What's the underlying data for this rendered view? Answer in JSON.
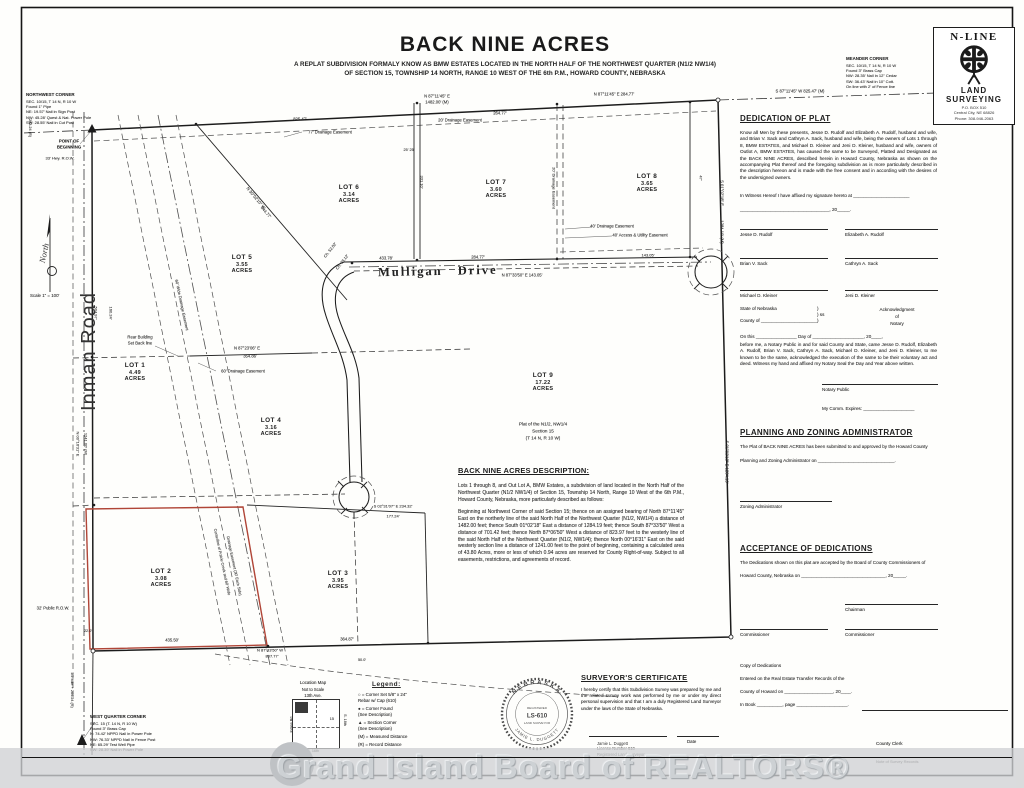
{
  "title": {
    "main": "BACK NINE ACRES",
    "sub1": "A REPLAT SUBDIVISION FORMALY KNOW AS BMW ESTATES LOCATED IN THE NORTH HALF OF THE NORTHWEST QUARTER (N1/2 NW1/4)",
    "sub2": "OF SECTION 15, TOWNSHIP 14 NORTH, RANGE 10 WEST OF THE 6th P.M., HOWARD COUNTY, NEBRASKA"
  },
  "logo": {
    "name": "N-LINE",
    "land": "LAND",
    "surveying": "SURVEYING",
    "addr1": "P.O. BOX 510",
    "addr2": "Central City, NE 68826",
    "addr3": "Phone: 308-946-2063"
  },
  "corner_notes": {
    "northwest": {
      "title": "NORTHWEST CORNER",
      "lines": [
        "SEC. 10/15, T 14 N, R 10 W",
        "Found 1\" Pipe",
        "NE: 19.57' Nail in Sign Post",
        "NW: 45.28' Quest & Nat. Power Pole",
        "SW: 28.55' Nail in Cut Post"
      ]
    },
    "meander": {
      "title": "MEANDER CORNER",
      "lines": [
        "SEC. 10/15, T 14 N, R 10 W",
        "Found 3\" Brass Cap",
        "NW: 28.35' Nail in 12\" Cedar",
        "SW: 36.43' Nail in 10\" Cott.",
        "On line with 2' of Fence line"
      ]
    },
    "west_quarter": {
      "title": "WEST QUARTER CORNER",
      "lines": [
        "SEC. 15 (T. 14 N, R 10 W)",
        "Found 3\" Brass Cap",
        "N: 74.42' NPPD Nail in Power Pole",
        "NW: 76.33' NPPD Nail in Fence Post",
        "NE: 65.29' Test Well Pipe",
        "SW: 28.39' Nail in Power Pole"
      ]
    }
  },
  "map": {
    "north": "North",
    "scale": "Scale 1\" = 100'",
    "inman": "Inman Road",
    "mulligan": "Mulligan Drive",
    "lots": [
      {
        "name": "LOT 1",
        "acres": "4.49 ACRES",
        "x": 135,
        "y": 372
      },
      {
        "name": "LOT 2",
        "acres": "3.08 ACRES",
        "x": 161,
        "y": 578
      },
      {
        "name": "LOT 3",
        "acres": "3.95 ACRES",
        "x": 338,
        "y": 580
      },
      {
        "name": "LOT 4",
        "acres": "3.16 ACRES",
        "x": 271,
        "y": 427
      },
      {
        "name": "LOT 5",
        "acres": "3.55 ACRES",
        "x": 242,
        "y": 264
      },
      {
        "name": "LOT 6",
        "acres": "3.14 ACRES",
        "x": 349,
        "y": 194
      },
      {
        "name": "LOT 7",
        "acres": "3.60 ACRES",
        "x": 496,
        "y": 189
      },
      {
        "name": "LOT 8",
        "acres": "3.65 ACRES",
        "x": 647,
        "y": 183
      },
      {
        "name": "LOT 9",
        "acres": "17.22 ACRES",
        "x": 543,
        "y": 382
      }
    ],
    "labels": [
      {
        "t": "825.47'",
        "x": 300,
        "y": 119,
        "s": 4.2
      },
      {
        "t": "77' Drainage Easement",
        "x": 330,
        "y": 132,
        "s": 4.2
      },
      {
        "t": "264.77'",
        "x": 500,
        "y": 113,
        "s": 4.2
      },
      {
        "t": "20' Drainage Easement",
        "x": 460,
        "y": 120,
        "s": 4.2
      },
      {
        "t": "N 87°11'45\" E",
        "x": 437,
        "y": 96,
        "s": 4.2
      },
      {
        "t": "1482.00' (M)",
        "x": 437,
        "y": 102,
        "s": 4.2
      },
      {
        "t": "N 87°11'45\" E  284.77'",
        "x": 614,
        "y": 94,
        "s": 4.2
      },
      {
        "t": "S 87°11'45\" W  825.47' (M)",
        "x": 800,
        "y": 91,
        "s": 4.2
      },
      {
        "t": "S 01°02'18\" E",
        "x": 722,
        "y": 193,
        "r": 90,
        "s": 4.2
      },
      {
        "t": "1284.19' (M)",
        "x": 722,
        "y": 232,
        "r": 90,
        "s": 4.2
      },
      {
        "t": "47'",
        "x": 701,
        "y": 178,
        "r": 90,
        "s": 4
      },
      {
        "t": "S 01°02'18\" E  1284.19'",
        "x": 727,
        "y": 462,
        "r": 90,
        "s": 4.2
      },
      {
        "t": "433.78'",
        "x": 386,
        "y": 258,
        "s": 4.2
      },
      {
        "t": "284.77'",
        "x": 478,
        "y": 257,
        "s": 4.2
      },
      {
        "t": "N 87°33'50\" E  143.05'",
        "x": 522,
        "y": 275,
        "s": 4.2
      },
      {
        "t": "143.05'",
        "x": 648,
        "y": 255,
        "s": 4
      },
      {
        "t": "Ch. 52.02'",
        "x": 330,
        "y": 250,
        "r": -52,
        "s": 4
      },
      {
        "t": "Ch. 78.12'",
        "x": 342,
        "y": 262,
        "r": -52,
        "s": 4
      },
      {
        "t": "N 30°02'10\" W",
        "x": 256,
        "y": 198,
        "r": 50,
        "s": 4.2
      },
      {
        "t": "844.77'",
        "x": 266,
        "y": 212,
        "r": 50,
        "s": 4.2
      },
      {
        "t": "60' Wide Drainage Easement",
        "x": 182,
        "y": 305,
        "r": 78,
        "s": 4
      },
      {
        "t": "Centerline of Prairie Creek and 60' Wide",
        "x": 222,
        "y": 562,
        "r": 78,
        "s": 3.8
      },
      {
        "t": "Drainage Easement (30' Each Side)",
        "x": 234,
        "y": 566,
        "r": 78,
        "s": 3.8
      },
      {
        "t": "N 87°23'06\" E",
        "x": 247,
        "y": 348,
        "s": 4.2
      },
      {
        "t": "354.86'",
        "x": 250,
        "y": 356,
        "s": 4.2
      },
      {
        "t": "60' Drainage Easement",
        "x": 243,
        "y": 371,
        "s": 4.2
      },
      {
        "t": "Rear Building",
        "x": 140,
        "y": 337,
        "s": 4.2
      },
      {
        "t": "Set Back line",
        "x": 140,
        "y": 343,
        "s": 4.2
      },
      {
        "t": "40' Drainage Easement",
        "x": 612,
        "y": 226,
        "s": 4.2
      },
      {
        "t": "40' Access & Utility Easement",
        "x": 640,
        "y": 235,
        "s": 4.2
      },
      {
        "t": "331.10'",
        "x": 422,
        "y": 182,
        "r": 90,
        "s": 4
      },
      {
        "t": "25' 25'",
        "x": 409,
        "y": 150,
        "s": 3.8
      },
      {
        "t": "20' Drainage Easement",
        "x": 554,
        "y": 188,
        "r": 90,
        "s": 4
      },
      {
        "t": "435.50'",
        "x": 172,
        "y": 640,
        "s": 4.2
      },
      {
        "t": "364.87'",
        "x": 347,
        "y": 639,
        "s": 4.2
      },
      {
        "t": "N 87°33'50\" W",
        "x": 270,
        "y": 650,
        "s": 4
      },
      {
        "t": "807.77'",
        "x": 272,
        "y": 656,
        "s": 4
      },
      {
        "t": "S 02°31'07\" E  234.32'",
        "x": 393,
        "y": 506,
        "s": 4
      },
      {
        "t": "177.24'",
        "x": 393,
        "y": 516,
        "s": 4
      },
      {
        "t": "504.97'",
        "x": 96,
        "y": 313,
        "r": 90,
        "s": 4
      },
      {
        "t": "160.24'",
        "x": 111,
        "y": 313,
        "r": 90,
        "s": 4
      },
      {
        "t": "N 00°16'31\" E",
        "x": 78,
        "y": 444,
        "r": 90,
        "s": 4
      },
      {
        "t": "1241.00' (M)",
        "x": 86,
        "y": 444,
        "r": 90,
        "s": 4
      },
      {
        "t": "32' Public R.O.W.",
        "x": 53,
        "y": 608,
        "s": 4.2
      },
      {
        "t": "22.0'",
        "x": 88,
        "y": 631,
        "s": 3.8
      },
      {
        "t": "1/2 Mile + 264.24 (R)",
        "x": 72,
        "y": 690,
        "r": 90,
        "s": 3.8
      },
      {
        "t": "283.24 (R)",
        "x": 30,
        "y": 128,
        "r": 90,
        "s": 3.8
      },
      {
        "t": "33' Hwy. R.O.W.",
        "x": 60,
        "y": 158,
        "s": 4
      },
      {
        "t": "POINT OF",
        "x": 69,
        "y": 141,
        "s": 4.3,
        "b": 1
      },
      {
        "t": "BEGINNING",
        "x": 69,
        "y": 147,
        "s": 4.3,
        "b": 1
      },
      {
        "t": "Plat of the N1/2, NW1/4",
        "x": 543,
        "y": 424,
        "s": 4.6
      },
      {
        "t": "Section 15",
        "x": 543,
        "y": 431,
        "s": 4.6
      },
      {
        "t": "(T 14 N, R 10 W)",
        "x": 543,
        "y": 438,
        "s": 4.6
      },
      {
        "t": "50.0'",
        "x": 362,
        "y": 660,
        "s": 3.8
      }
    ]
  },
  "description": {
    "heading": "BACK NINE ACRES DESCRIPTION:",
    "para1": "Lots 1 through 8, and Out Lot A, BMW Estates, a subdivision of land located in the North Half of the Northwest Quarter (N1/2 NW1/4) of Section 15, Township 14 North, Range 10 West of the 6th P.M., Howard County, Nebraska, more particularly described as follows:",
    "para2": "Beginning at Northwest Corner of said Section 15; thence on an assigned bearing of North 87°11'45\" East on the northerly line of the said North Half of the Northwest Quarter (N1/2, NW1/4) a distance of 1482.00 feet; thence South 01°02'18\" East a distance of 1284.19 feet; thence South 87°33'50\" West a distance of 701.42 feet; thence North 87°06'50\" West a distance of 823.97 feet to the westerly line of the said North Half of the Northwest Quarter (N1/2, NW1/4); thence North 00°16'31\" East on the said westerly section line a distance of 1241.00 feet to the point of beginning, containing a calculated area of 43.80 Acres, more or less of which 0.94 acres are reserved for County Right-of-way.  Subject to all easements, restrictions, and agreements of record."
  },
  "dedication": {
    "heading": "DEDICATION OF PLAT",
    "body": "Know all Men by these presents, Jesse D. Rudolf and Elizabeth A. Rudolf, husband and wife, and Brian V. Sack and Cathryn A. Sack, husband and wife, being the owners of Lots 1 through 8, BMW ESTATES, and Michael D. Kleiner and Jeni D. Kleiner, husband and wife, owners of Outlot A, BMW ESTATES, has caused the same to be Surveyed, Platted and Designated as the BACK NINE ACRES, described herein in Howard County, Nebraska as shown on the accompanying Plat thereof and the foregoing subdivision as is more particularly described in the description hereon and is made with the free consent and in according with the desires of the undersigned owners.",
    "witness1": "In Witness Hereof I have affixed my signature hereto at ______________________",
    "witness2": "___________________________________, 20_____.",
    "signers": [
      "Jesse D. Rudolf",
      "Elizabeth A. Rudolf",
      "Brian V. Sack",
      "Cathryn A. Sack",
      "Michael D. Kleiner",
      "Jeni D. Kleiner"
    ]
  },
  "notary": {
    "state": "State of Nebraska",
    "paren": ")",
    "ss": ") ss",
    "county": "County of ______________________",
    "ack1": "Acknowledgment",
    "ack2": "of",
    "ack3": "Notary",
    "line1": "On this ________________ Day of ____________________, 20____,",
    "body": "before me, a Notary Public in and for said County and State, came Jesse D. Rudolf, Elizabeth A. Rudolf, Brian V. Sack, Cathryn A. Sack, Michael D. Kleiner, and Jeni D. Kleiner, to me known to be the same, acknowledged the execution of the same to be their voluntary act and deed.  Witness my hand and affixed my Notary Seal the Day and Year above written.",
    "public_label": "Notary Public",
    "comm": "My Comm. Expires: ____________________"
  },
  "planning": {
    "heading": "PLANNING AND ZONING ADMINISTRATOR",
    "line1": "The Plat of  BACK NINE ACRES  has been submitted to and approved by the Howard County",
    "line2": "Planning and Zoning Administrator on ______________________________.",
    "sig": "Zoning Administrator"
  },
  "acceptance": {
    "heading": "ACCEPTANCE OF DEDICATIONS",
    "line1": "The Dedications shown on this plat are accepted by the Board of County Commissioners of",
    "line2": "Howard County, Nebraska on _________________________________, 20_____.",
    "chairman": "Chairman",
    "commissioner": "Commissioner"
  },
  "recording": {
    "t1": "Copy of Dedications",
    "t2": "Entered on the  Real Estate Transfer Records of the",
    "t3": "County of Howard on ___________________, 20____.",
    "t4": "In Book __________, page ____________________.",
    "clerk": "County Clerk",
    "note": "Note of Survey Records"
  },
  "location_map": {
    "title": "Location Map",
    "sub": "Not to Scale",
    "ave": "13th Ave.",
    "left": "Inman Rd.",
    "right": "S. 16th",
    "bottom": "G. 16th",
    "sec": "15"
  },
  "legend": {
    "heading": "Legend:",
    "items": [
      "○ = Corner Set 5/8\" x 24\"\n        Rebar w/ Cap (610)",
      "● = Corner Found\n        (See Description)",
      "▲ = Section Corner\n        (See Description)",
      "(M) = Measured Distance",
      "(R) = Record Distance"
    ]
  },
  "seal": {
    "state": "NEBRASKA",
    "registered": "REGISTERED",
    "number": "LS-610",
    "land_surveyor": "LAND SURVEYOR",
    "name": "JAMIE L. DUGGETT"
  },
  "certificate": {
    "heading": "SURVEYOR'S CERTIFICATE",
    "body": "I hereby certify that this Subdivision Survey was prepared by me and the related survey work was performed by me or under my direct personal supervision and that I am a duly Registered Land Surveyor under the laws of the State of Nebraska.",
    "sig_name": "Jamie L. Duggett",
    "sig_license": "License Number 610",
    "sig_reg": "Registered Land Surveyor",
    "date_label": "Date"
  },
  "watermark": {
    "text": "Grand Island Board of REALTORS®"
  },
  "colors": {
    "plat_red": "#b04537",
    "watermark_gray": "#cdd1d4",
    "line_black": "#1c1c1c"
  }
}
